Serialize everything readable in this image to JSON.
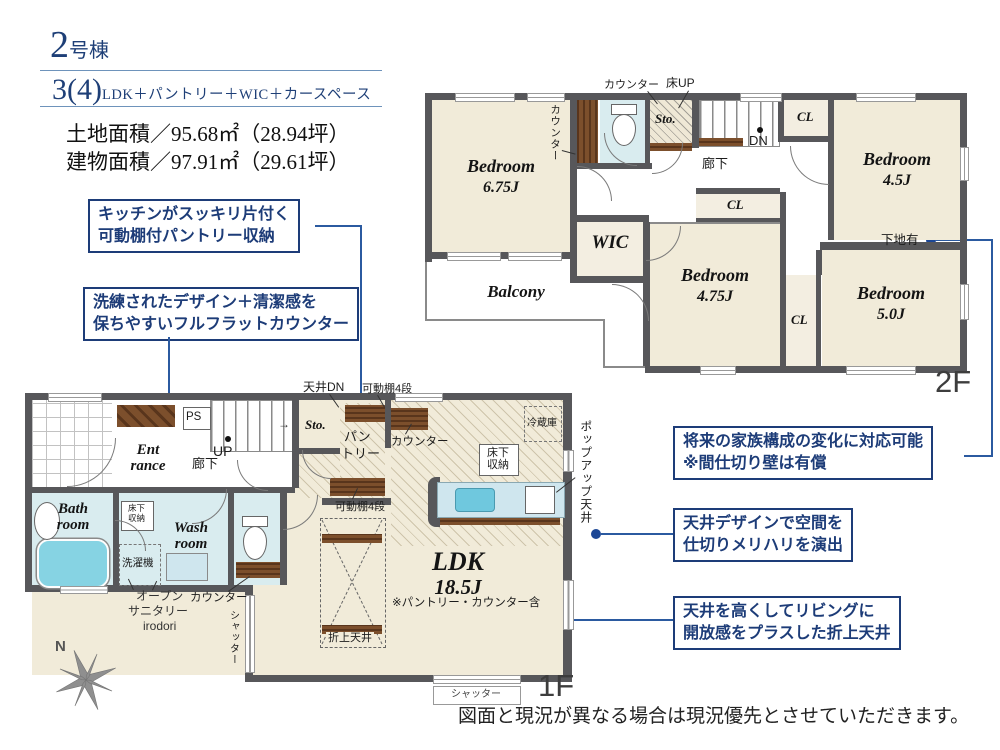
{
  "header": {
    "building_no": "2",
    "building_suffix": "号棟",
    "plan_num": "3(4)",
    "plan_text": "LDK＋パントリー＋WIC＋カースペース",
    "land_area": "土地面積／95.68㎡（28.94坪）",
    "building_area": "建物面積／97.91㎡（29.61坪）"
  },
  "callouts": {
    "pantry_line1": "キッチンがスッキリ片付く",
    "pantry_line2": "可動棚付パントリー収納",
    "counter_line1": "洗練されたデザイン＋清潔感を",
    "counter_line2": "保ちやすいフルフラットカウンター",
    "partition_line1": "将来の家族構成の変化に対応可能",
    "partition_line2": "※間仕切り壁は有償",
    "ceiling_line1": "天井デザインで空間を",
    "ceiling_line2": "仕切りメリハリを演出",
    "coffered_line1": "天井を高くしてリビングに",
    "coffered_line2": "開放感をプラスした折上天井"
  },
  "floor2": {
    "label": "2F",
    "bed675_name": "Bedroom",
    "bed675_size": "6.75J",
    "bed45_name": "Bedroom",
    "bed45_size": "4.5J",
    "bed475_name": "Bedroom",
    "bed475_size": "4.75J",
    "bed50_name": "Bedroom",
    "bed50_size": "5.0J",
    "wic": "WIC",
    "balcony": "Balcony",
    "sto": "Sto.",
    "cl_top": "CL",
    "cl_mid": "CL",
    "cl_right": "CL",
    "corridor": "廊下",
    "counter_top": "カウンター",
    "yuka_up": "床UP",
    "counter_side": "カウンター",
    "dn": "DN",
    "shitaji": "下地有"
  },
  "floor1": {
    "label": "1F",
    "ent1": "Ent",
    "ent2": "rance",
    "ps": "PS",
    "up": "UP",
    "arrow": "→",
    "corridor": "廊下",
    "sto": "Sto.",
    "tenjo_dn": "天井DN",
    "shelf_top": "可動棚4段",
    "shelf_btm": "可動棚4段",
    "pantry1": "パン",
    "pantry2": "トリー",
    "counter_kitchen": "カウンター",
    "fridge": "冷蔵庫",
    "yukashita_k1": "床下",
    "yukashita_k2": "収納",
    "popup_ceiling": "ポップアップ天井",
    "bath1": "Bath",
    "bath2": "room",
    "yukashita_w1": "床下",
    "yukashita_w2": "収納",
    "wash1": "Wash",
    "wash2": "room",
    "washer": "洗濯機",
    "open1": "オープン",
    "open2": "サニタリー",
    "open3": "irodori",
    "counter_wash": "カウンター",
    "shutter_left": "シャッター",
    "shutter_bottom": "シャッター",
    "ldk_name": "LDK",
    "ldk_size": "18.5J",
    "ldk_note": "※パントリー・カウンター含",
    "oriage": "折上天井",
    "north": "N"
  },
  "footer": {
    "disclaimer": "図面と現況が異なる場合は現況優先とさせていただきます。"
  },
  "colors": {
    "navy": "#1d3c78",
    "connector": "#2b5aa0",
    "wall": "#57575a",
    "room_cream": "#f1ebd9",
    "room_blue": "#d9ecef",
    "tub": "#86d3e3",
    "wood": "#6e4527"
  }
}
